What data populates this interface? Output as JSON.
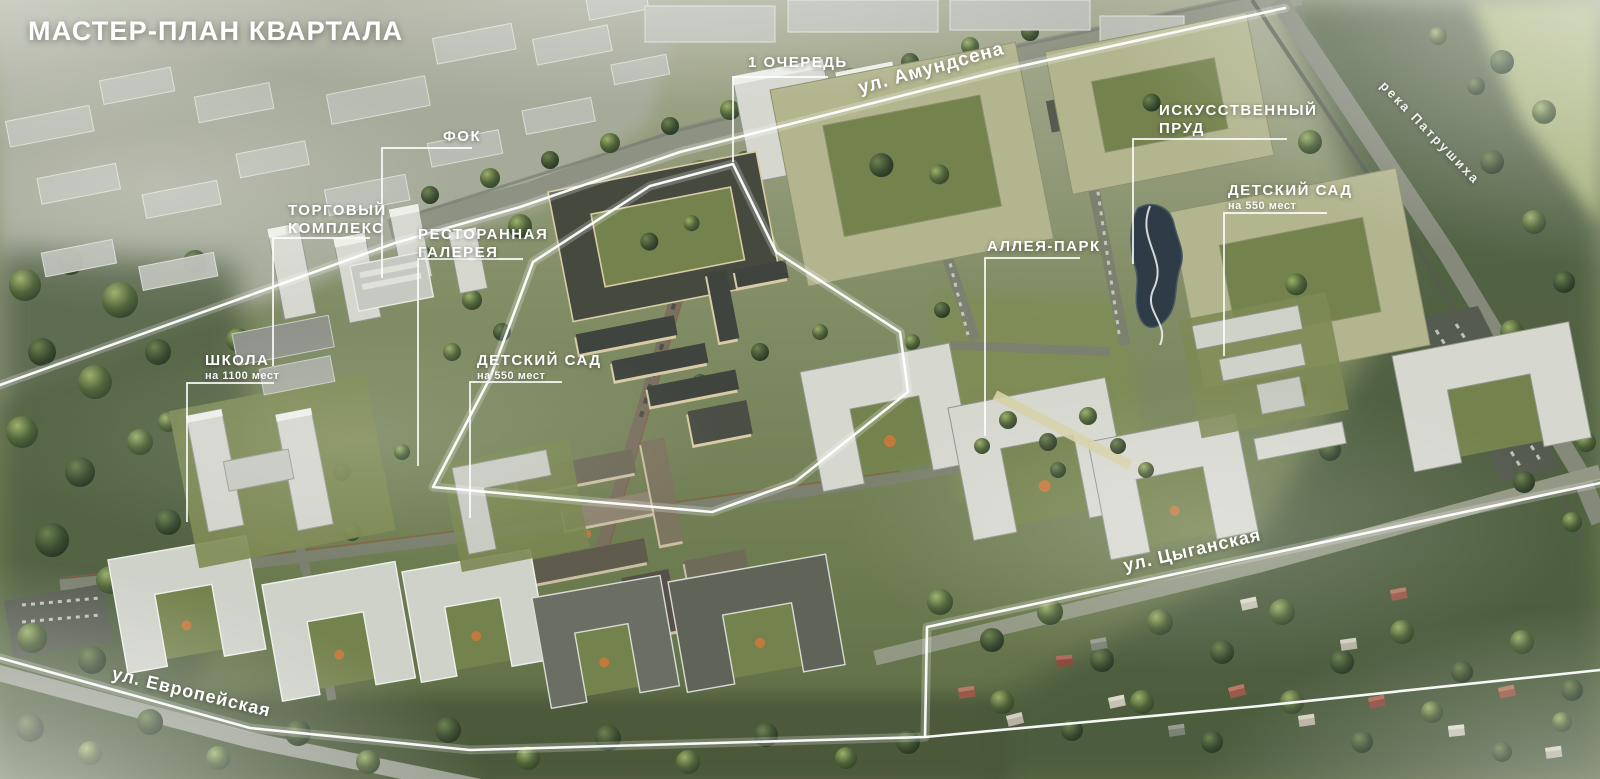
{
  "title": "МАСТЕР-ПЛАН КВАРТАЛА",
  "callouts": {
    "phase1": {
      "label": "1 ОЧЕРЕДЬ"
    },
    "fok": {
      "label": "ФОК"
    },
    "shopping_complex": {
      "line1": "ТОРГОВЫЙ",
      "line2": "КОМПЛЕКС"
    },
    "restaurant_gallery": {
      "line1": "РЕСТОРАННАЯ",
      "line2": "ГАЛЕРЕЯ"
    },
    "artificial_pond": {
      "line1": "ИСКУССТВЕННЫЙ",
      "line2": "ПРУД"
    },
    "kindergarten_right": {
      "label": "ДЕТСКИЙ САД",
      "capacity": "на 550 мест"
    },
    "alley_park": {
      "label": "АЛЛЕЯ-ПАРК"
    },
    "school": {
      "label": "ШКОЛА",
      "capacity": "на 1100 мест"
    },
    "kindergarten_left": {
      "label": "ДЕТСКИЙ САД",
      "capacity": "на 550 мест"
    }
  },
  "streets": {
    "amundsen": "ул. Амундсена",
    "tsyganskaya": "ул. Цыганская",
    "evropeyskaya": "ул. Европейская"
  },
  "river": "река Патрушиха",
  "colors": {
    "label_text": "#ffffff",
    "boundary_line": "#ffffff",
    "terrain_green": "#7d8a5f",
    "forest_green": "#44543a",
    "building_light": "#d6d8d0",
    "building_olive": "#b2b58e",
    "building_cream": "#d8cba6",
    "roof_dark": "#45493e",
    "pond_water": "#2d3c46",
    "playground_orange": "#c07a3c"
  }
}
